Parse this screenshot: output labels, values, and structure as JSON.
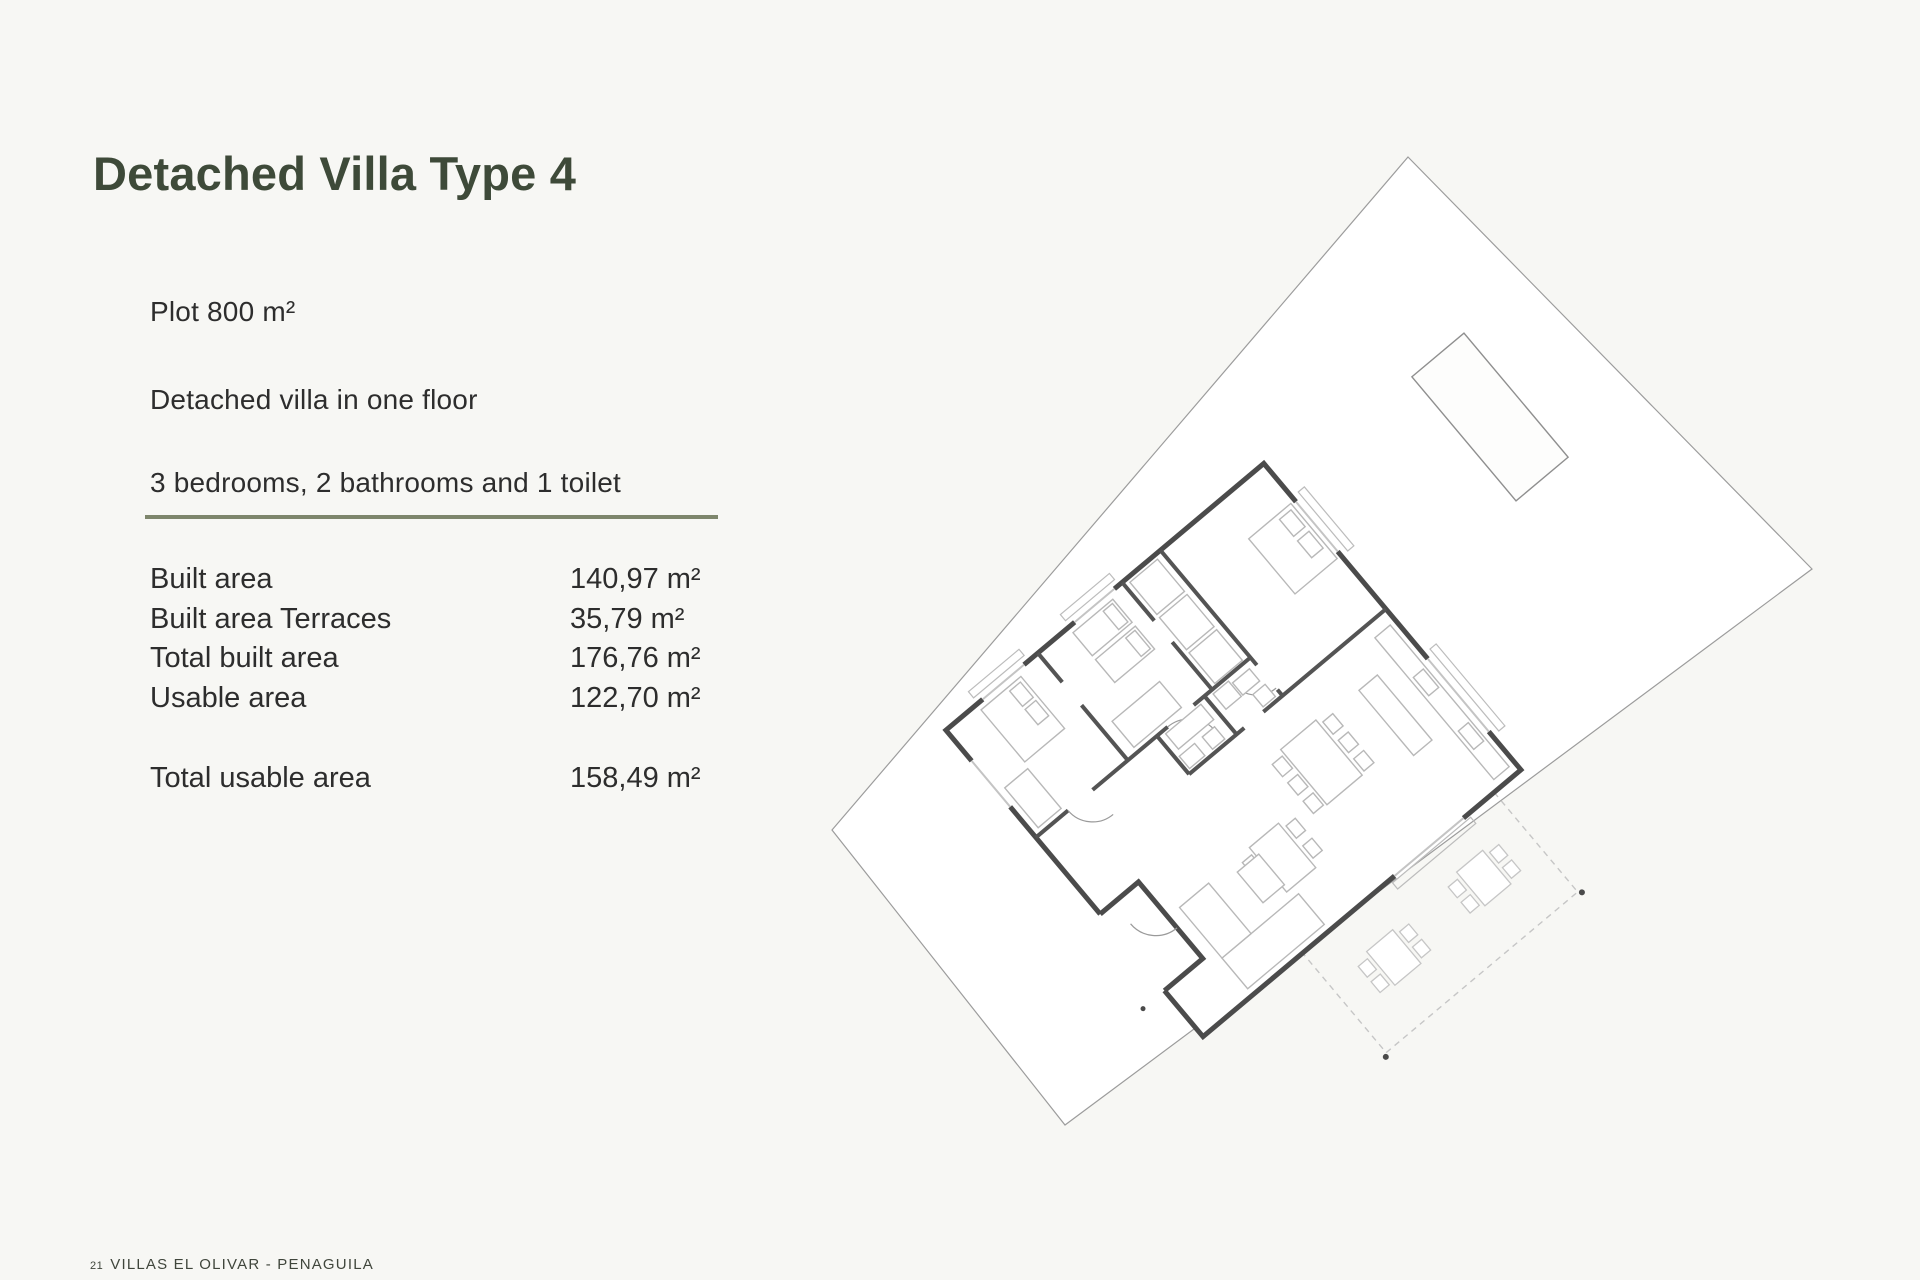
{
  "colors": {
    "background": "#f7f7f4",
    "title": "#3e4a39",
    "body_text": "#2d2d2d",
    "divider": "#7e866c",
    "footer_text": "#40463c",
    "plan_wall": "#4b4b4b",
    "plan_furniture": "#b8b8b8"
  },
  "title": "Detached Villa Type 4",
  "specs": [
    "Plot 800 m²",
    "Detached villa in one floor",
    "3 bedrooms, 2 bathrooms and 1 toilet"
  ],
  "areas": {
    "rows": [
      {
        "label": "Built area",
        "value": "140,97 m²"
      },
      {
        "label": "Built area Terraces",
        "value": "35,79 m²"
      },
      {
        "label": "Total built area",
        "value": "176,76 m²"
      },
      {
        "label": "Usable area",
        "value": "122,70 m²"
      }
    ],
    "total_row": {
      "label": "Total usable area",
      "value": "158,49 m²"
    }
  },
  "footer": {
    "page_number": "21",
    "project_name": "VILLAS EL OLIVAR - PENAGUILA"
  },
  "floor_plan": {
    "description": "site plan of detached villa type 4 with pool, rotated plot"
  }
}
